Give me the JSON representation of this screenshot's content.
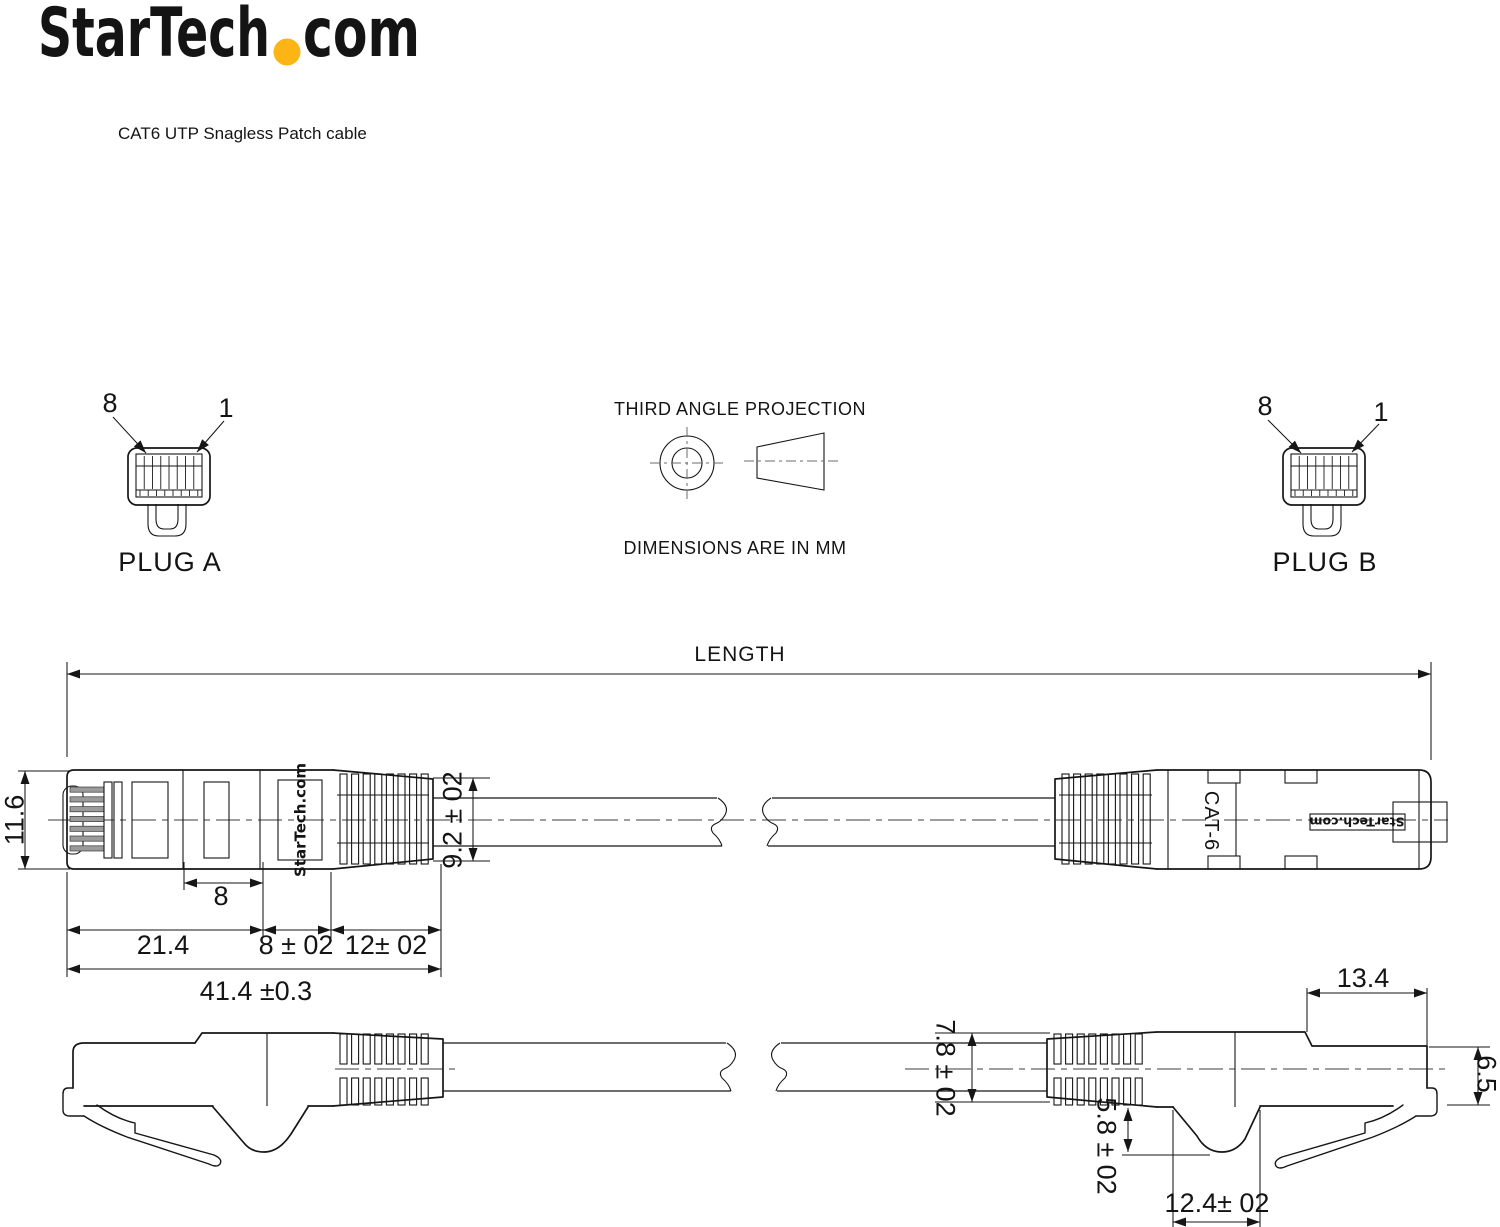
{
  "header": {
    "logo_text": "StarTech",
    "logo_suffix": "com",
    "logo_dot_color": "#FDB515",
    "subtitle": "CAT6 UTP Snagless Patch cable"
  },
  "plug_a": {
    "label": "PLUG A",
    "pin_left": "8",
    "pin_right": "1"
  },
  "plug_b": {
    "label": "PLUG B",
    "pin_left": "8",
    "pin_right": "1"
  },
  "projection": {
    "title": "THIRD ANGLE PROJECTION",
    "units_note": "DIMENSIONS ARE IN MM"
  },
  "length_dim": {
    "label": "LENGTH"
  },
  "side_view": {
    "height": "11.6",
    "boot_od": "9.2 ± 02",
    "latch_window": "8",
    "body_len": "21.4",
    "boot_len": "8 ± 02",
    "ribs_len": "12± 02",
    "overall_len": "41.4 ±0.3",
    "marking": "StarTech.com"
  },
  "bottom_view": {
    "nose_len": "13.4",
    "cable_od": "7.8 ± 02",
    "nose_height": "6.5",
    "latch_depth": "5.8 ± 02",
    "hump_len": "12.4± 02",
    "marking_cat": "CAT-6",
    "marking_brand": "StarTech.com"
  },
  "colors": {
    "line": "#161616",
    "accent_yellow": "#FDB515",
    "pin_fill": "#9b9b9b"
  }
}
